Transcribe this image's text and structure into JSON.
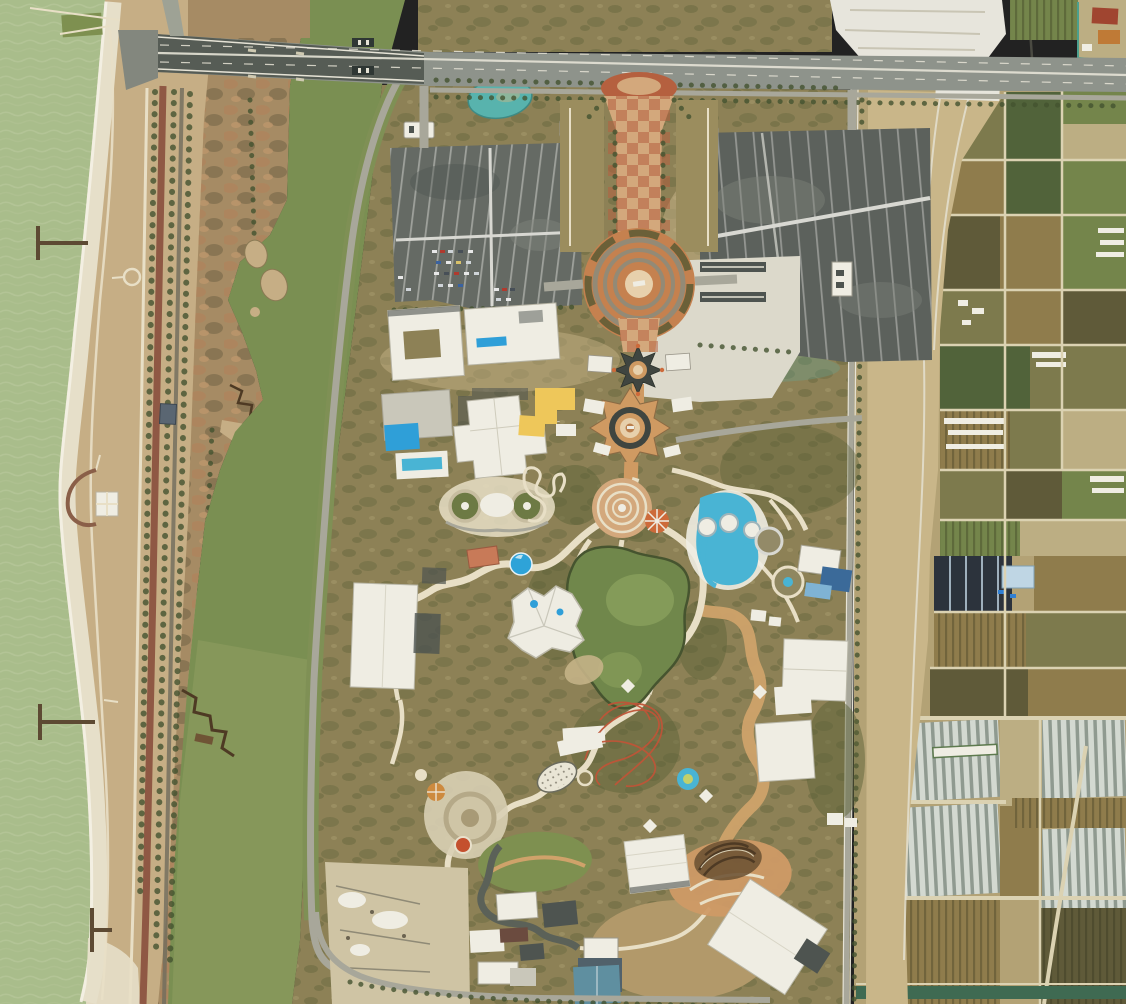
{
  "scene": {
    "type": "satellite-aerial-photograph",
    "description": "Aerial satellite view of a coastal ocean-theme amusement park under construction: sea, beach and wetland river corridor on the west, a highway bridge across the top, brick entrance esplanade with circular plaza and star-shaped gate, two large parking lots, winding park paths around a green lagoon, water slides, a red roller coaster, and farmland with greenhouse tunnels to the east.",
    "regions": [
      "sea",
      "beach",
      "coastal-dunes",
      "coastal-parkway",
      "wetland-marsh",
      "river-channel",
      "highway-bridge",
      "construction-interchange",
      "entrance-esplanade",
      "circular-plaza",
      "entrance-gate",
      "castle-courtyard",
      "west-parking-lot",
      "east-parking-lot",
      "theme-park-grounds",
      "central-lagoon",
      "water-ride-complex",
      "roller-coaster",
      "carousel-court",
      "southeast-plaza",
      "wooden-coaster",
      "warehouses",
      "farmland-grid",
      "dark-greenhouses",
      "greenhouse-tunnels",
      "irrigation-canal",
      "farm-dirt-road"
    ]
  },
  "palette": {
    "sea": "#a9bd8b",
    "seaWave": "#bcc99e",
    "beach": "#e6dfc9",
    "surf": "#f4f1e4",
    "dune": "#c6ae85",
    "marsh": "#a68b64",
    "marshRust": "#b1835c",
    "marshDark": "#6b5f41",
    "treeDark": "#44522f",
    "redRoad": "#8f5844",
    "river": "#7a8f52",
    "riverLight": "#95a264",
    "verge": "#7f9055",
    "roadGray": "#a8a79a",
    "highway": "#8e938b",
    "bridge": "#565c55",
    "laneWhite": "#e6e3d6",
    "construct": "#e7e5dc",
    "scrub": "#8d8156",
    "shrub": "#5c6238",
    "pathCream": "#e8dfc6",
    "pathTan": "#cfa26a",
    "asphalt": "#656a64",
    "asphaltDark": "#5c615c",
    "lotLight": "#7e827a",
    "aisleWhite": "#d8d8d2",
    "apron": "#dcd9cb",
    "brick": "#b5603f",
    "brickTan": "#d3a87c",
    "plazaOrange": "#c5814f",
    "ringGray": "#938a76",
    "roofDark": "#3f4540",
    "wallOrange": "#cf9a62",
    "courtPale": "#e7d0ac",
    "accentOrange": "#cd6a3a",
    "yellow": "#eec75a",
    "poolBlue": "#2f9fd8",
    "slideCyan": "#49b4d4",
    "domeBlue": "#2ea3d8",
    "roofBlue": "#3b6a99",
    "tealPond": "#58b3ad",
    "lagoon": "#70874b",
    "lagoonLight": "#8aa05c",
    "coasterRed": "#bf5538",
    "white": "#efede3",
    "grayBldg": "#c9c7ba",
    "darkBldg": "#4e5450",
    "woodBrown": "#6f5435",
    "woodDark": "#4e3a24",
    "orangePlaza": "#cf9a66",
    "lawn": "#7e9050",
    "streetDark": "#5b6158",
    "dirt": "#c9b689",
    "fieldGreen": "#74854b",
    "fieldGreenDark": "#51633a",
    "fieldOlive": "#7d7a4d",
    "fieldBrown": "#8f7c4c",
    "fieldDark": "#5f5a39",
    "fieldPale": "#bcae83",
    "ghDark": "#2c333c",
    "ghBase": "#8f9a90",
    "ghStripe": "#d3d9d1",
    "canal": "#3f6a52",
    "redBldg": "#a04530",
    "craneOrange": "#bf7a36"
  }
}
